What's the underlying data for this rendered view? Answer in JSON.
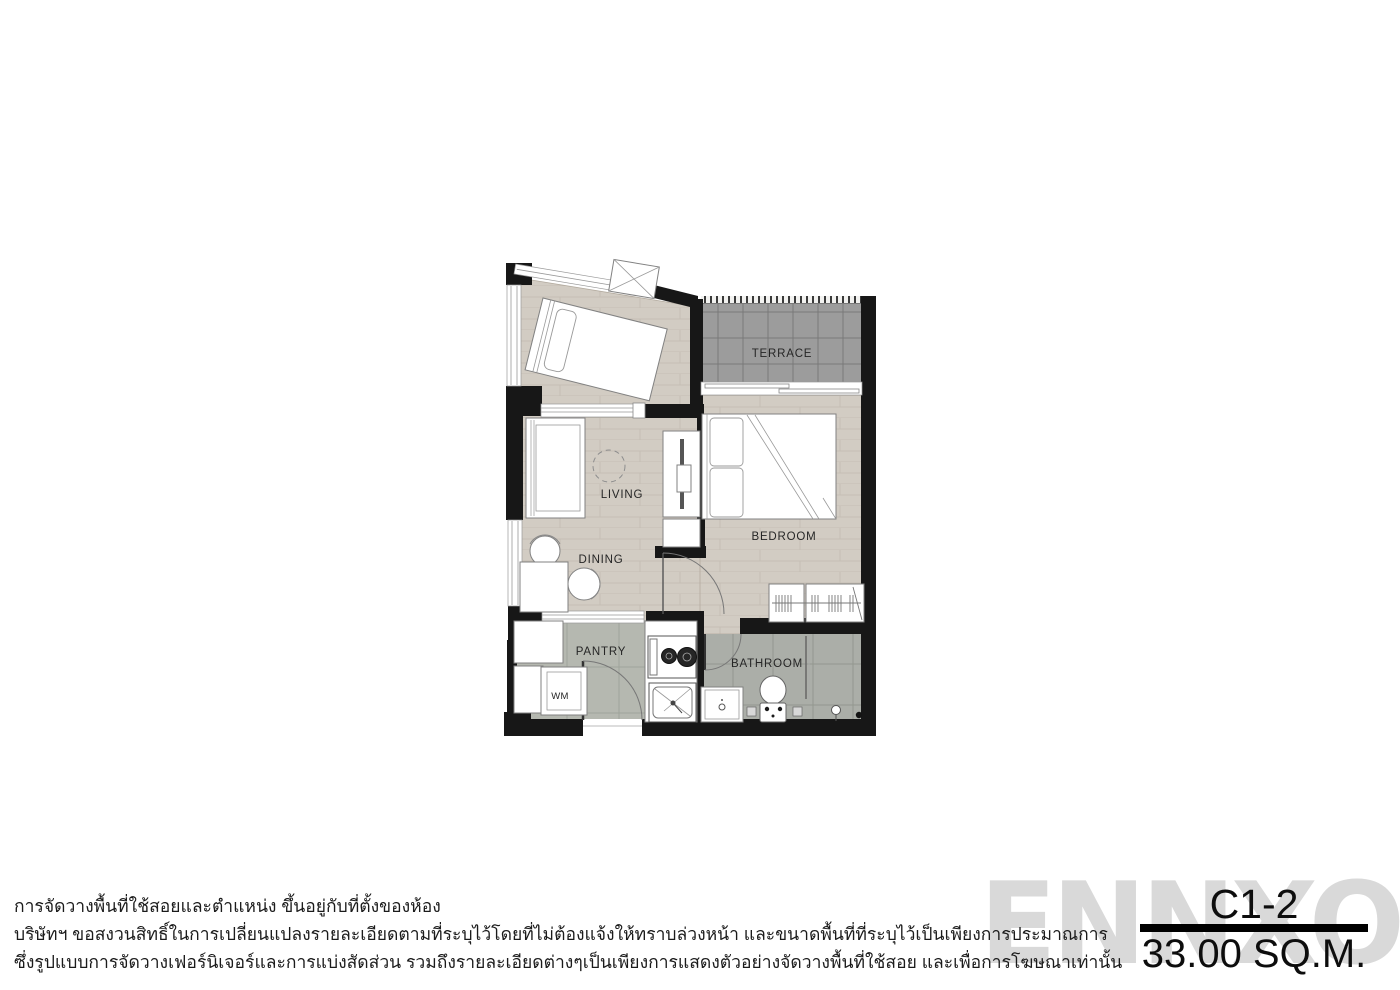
{
  "unit": {
    "code": "C1-2",
    "area": "33.00 SQ.M."
  },
  "watermark": "ENNXO",
  "plan": {
    "labels": {
      "terrace": "TERRACE",
      "living": "LIVING",
      "dining": "DINING",
      "bedroom": "BEDROOM",
      "pantry": "PANTRY",
      "bathroom": "BATHROOM",
      "wm": "WM"
    }
  },
  "disclaimer": {
    "line1": "การจัดวางพื้นที่ใช้สอยและตำแหน่ง ขึ้นอยู่กับที่ตั้งของห้อง",
    "line2": "บริษัทฯ ขอสงวนสิทธิ์ในการเปลี่ยนแปลงรายละเอียดตามที่ระบุไว้โดยที่ไม่ต้องแจ้งให้ทราบล่วงหน้า และขนาดพื้นที่ที่ระบุไว้เป็นเพียงการประมาณการ",
    "line3": "ซึ่งรูปแบบการจัดวางเฟอร์นิเจอร์และการแบ่งสัดส่วน รวมถึงรายละเอียดต่างๆเป็นเพียงการแสดงตัวอย่างจัดวางพื้นที่ใช้สอย และเพื่อการโฆษณาเท่านั้น"
  },
  "colors": {
    "wall": "#171717",
    "wood_floor": "#d2ccc3",
    "wood_line": "#c5beb4",
    "terrace_tile": "#9c9c9c",
    "terrace_line": "#7a7a7a",
    "pantry_tile": "#b5b8b0",
    "bath_tile": "#abaea8",
    "furniture_stroke": "#818181",
    "watermark_gray": "#d9d9d9"
  }
}
